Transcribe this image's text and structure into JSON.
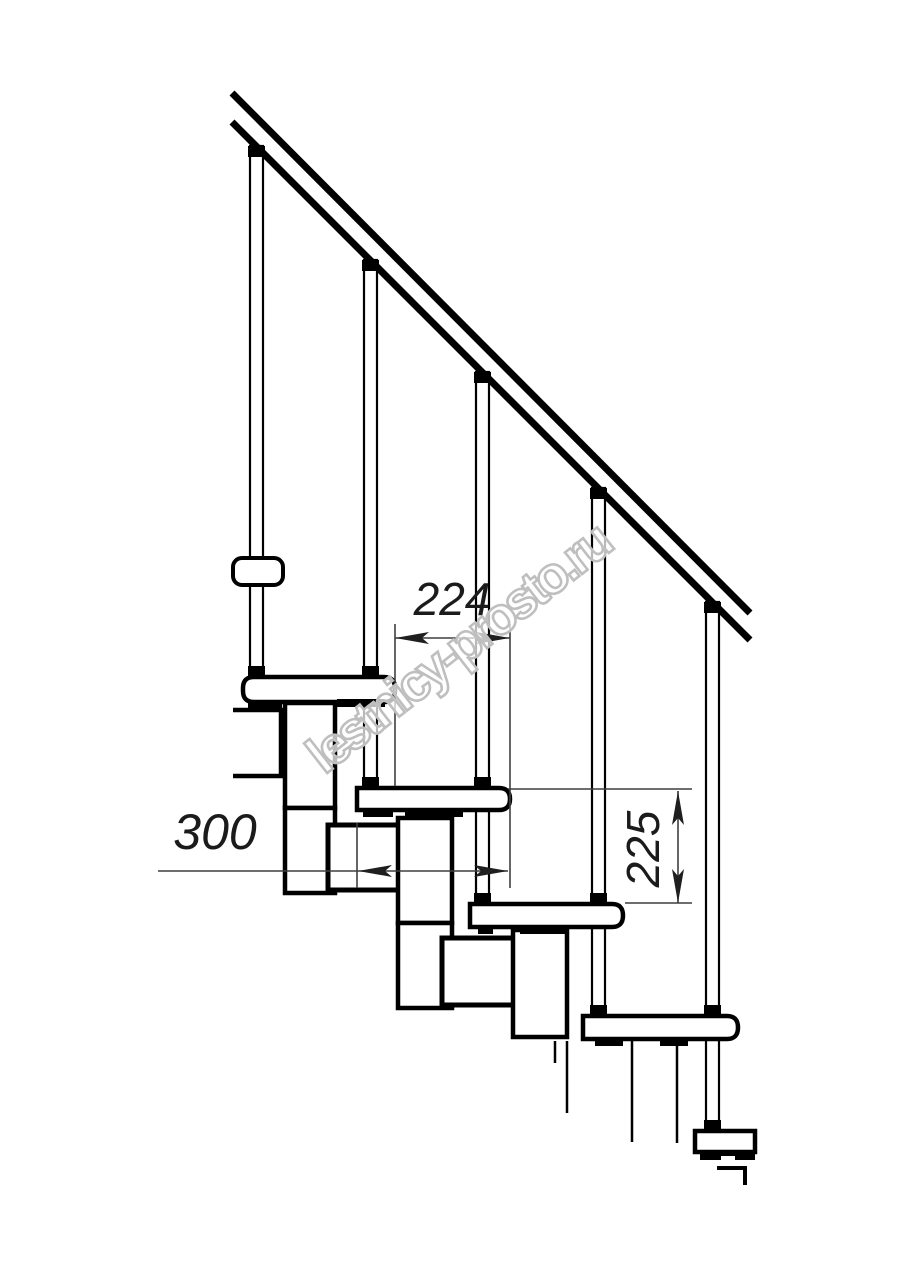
{
  "drawing": {
    "watermark": {
      "text": "lestnicy-prosto.ru"
    },
    "dimensions": {
      "step_run": {
        "value": "224"
      },
      "tread_depth": {
        "value": "300"
      },
      "step_rise": {
        "value": "225"
      }
    },
    "colors": {
      "background": "#ffffff",
      "line": "#000000",
      "dimension_line": "#3f3f3f",
      "dimension_text": "#1b1b1b",
      "watermark_stroke": "#bfbfbf"
    }
  }
}
